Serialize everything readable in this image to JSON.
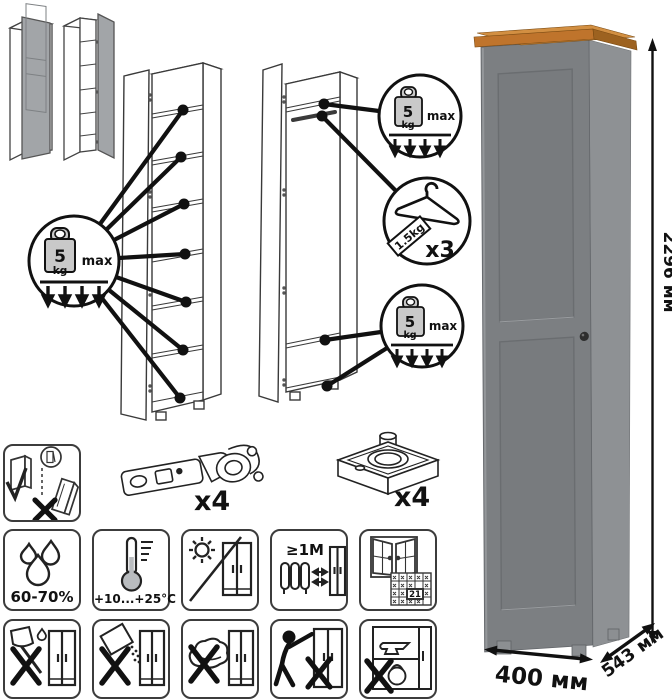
{
  "load": {
    "value": "5",
    "unit": "kg",
    "max_label": "max"
  },
  "hanger": {
    "weight_tag": "1.5kg",
    "quantity": "x3"
  },
  "hardware": {
    "hinge_quantity": "x4",
    "foot_quantity": "x4"
  },
  "care": {
    "humidity": "60-70%",
    "temperature": "+10...+25°C",
    "min_distance": "≥1M",
    "acclimatization_days": "21"
  },
  "dimensions": {
    "height": "2296 мм",
    "width": "400 мм",
    "depth": "543 мм"
  },
  "colors": {
    "cabinet_front": "#7c7f82",
    "cabinet_side": "#8e9194",
    "top_wood": "#c9813a",
    "line_art": "#1a1a1a"
  }
}
